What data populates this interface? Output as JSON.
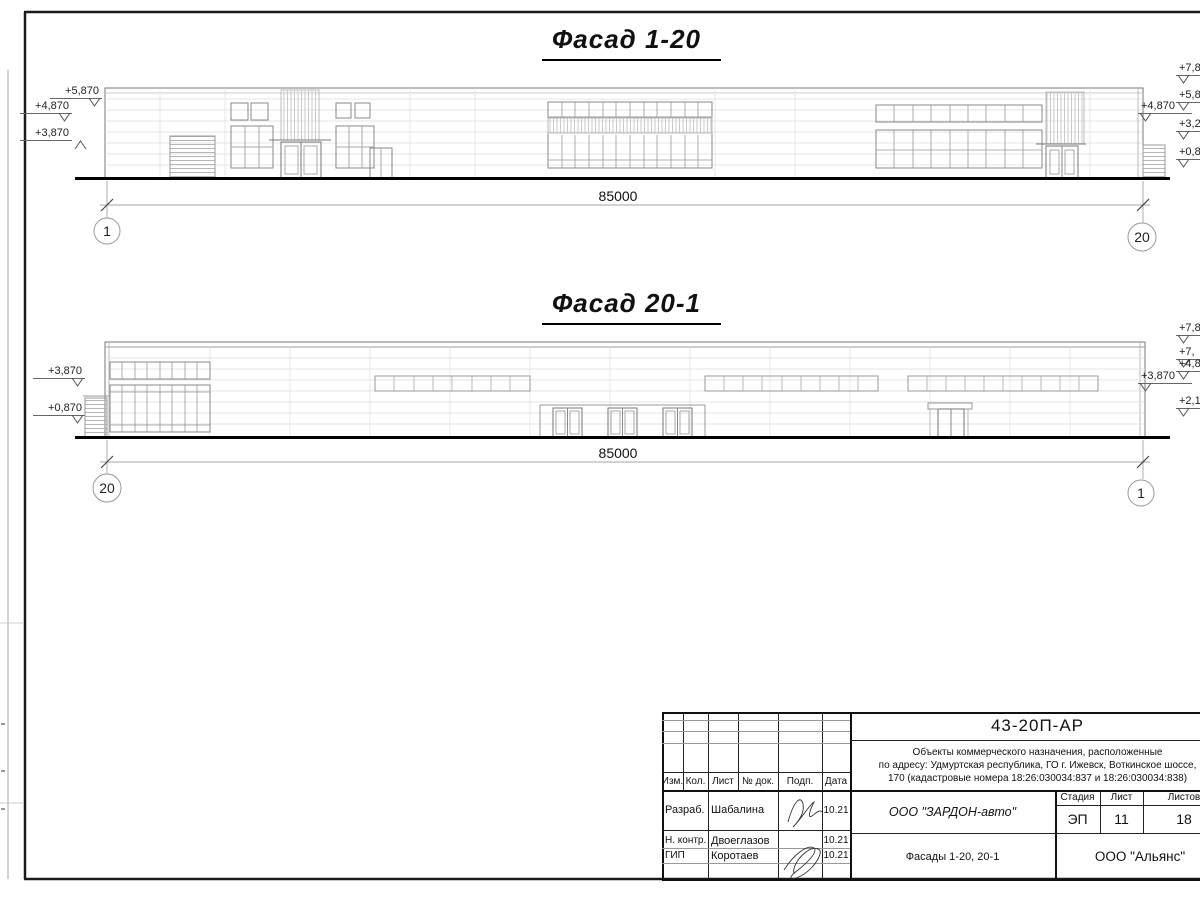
{
  "sheet": {
    "facade1": {
      "title": "Фасад 1-20",
      "dimension": "85000",
      "axis_left": "1",
      "axis_right": "20",
      "elev_left": [
        "+5,870",
        "+4,870",
        "+3,870"
      ],
      "elev_right": "+4,870",
      "elev_edge": [
        "+7,87",
        "+5,87",
        "+3,27",
        "+0,87"
      ]
    },
    "facade2": {
      "title": "Фасад 20-1",
      "dimension": "85000",
      "axis_left": "20",
      "axis_right": "1",
      "elev_left": [
        "+3,870",
        "+0,870"
      ],
      "elev_right": "+3,870",
      "elev_edge": [
        "+7,8",
        "+7,",
        "+4,8",
        "+2,1"
      ]
    },
    "titleblock": {
      "doc_number": "43-20П-АР",
      "project_name_lines": [
        "Объекты коммерческого назначения, расположенные",
        "по адресу: Удмуртская республика, ГО г. Ижевск, Воткинское шоссе,",
        "170 (кадастровые номера 18:26:030034:837 и 18:26:030034:838)"
      ],
      "header": {
        "izm": "Изм.",
        "kol": "Кол.",
        "list": "Лист",
        "doc": "№ док.",
        "podp": "Подп.",
        "data": "Дата"
      },
      "rows": [
        {
          "role": "Разраб.",
          "name": "Шабалина",
          "date": "10.21"
        },
        {
          "role": "Н. контр.",
          "name": "Двоеглазов",
          "date": "10.21"
        },
        {
          "role": "ГИП",
          "name": "Коротаев",
          "date": "10.21"
        }
      ],
      "stage_label": "Стадия",
      "sheet_label": "Лист",
      "sheets_label": "Листов",
      "stage": "ЭП",
      "sheet_no": "11",
      "sheets_total": "18",
      "company": "ООО \"ЗАРДОН-авто\"",
      "drawing_title": "Фасады 1-20, 20-1",
      "contractor": "ООО \"Альянс\""
    }
  }
}
